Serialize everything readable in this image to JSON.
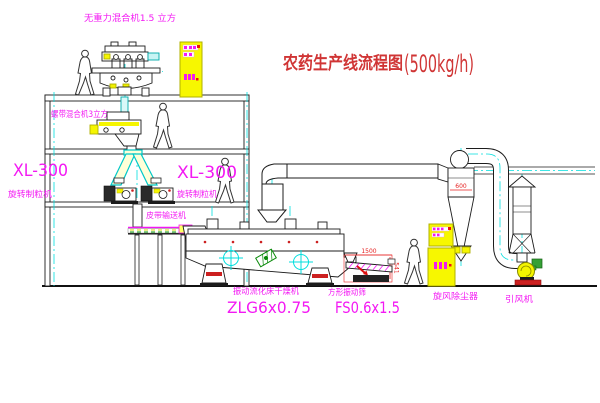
{
  "title": {
    "main": "农药生产线流程图",
    "capacity": "(500kg/h)"
  },
  "labels": {
    "mixer_top": "无重力混合机1.5 立方",
    "mixer_mid": "螺带混合机3立方",
    "xl300_left": "XL-300",
    "xl300_left_sub": "旋转制粒机",
    "xl300_mid": "XL-300",
    "xl300_mid_sub": "旋转制粒机",
    "belt_conveyor": "皮带输送机",
    "dryer_name": "振动流化床干燥机",
    "dryer_model": "ZLG6x0.75",
    "sieve_name": "方形振动筛",
    "sieve_model": "FS0.6x1.5",
    "cyclone": "旋风除尘器",
    "fan": "引风机"
  },
  "dimensions": {
    "cyclone_width": "600",
    "sieve_length": "1500",
    "sieve_height": "541"
  },
  "colors": {
    "line": "#1c1c1c",
    "accent_yellow": "#f5f500",
    "centerline_cyan": "#00dede",
    "label_magenta": "#f319f3",
    "title_red": "#d03535",
    "dim_red": "#e62222",
    "detail_green": "#2e9b2e"
  }
}
